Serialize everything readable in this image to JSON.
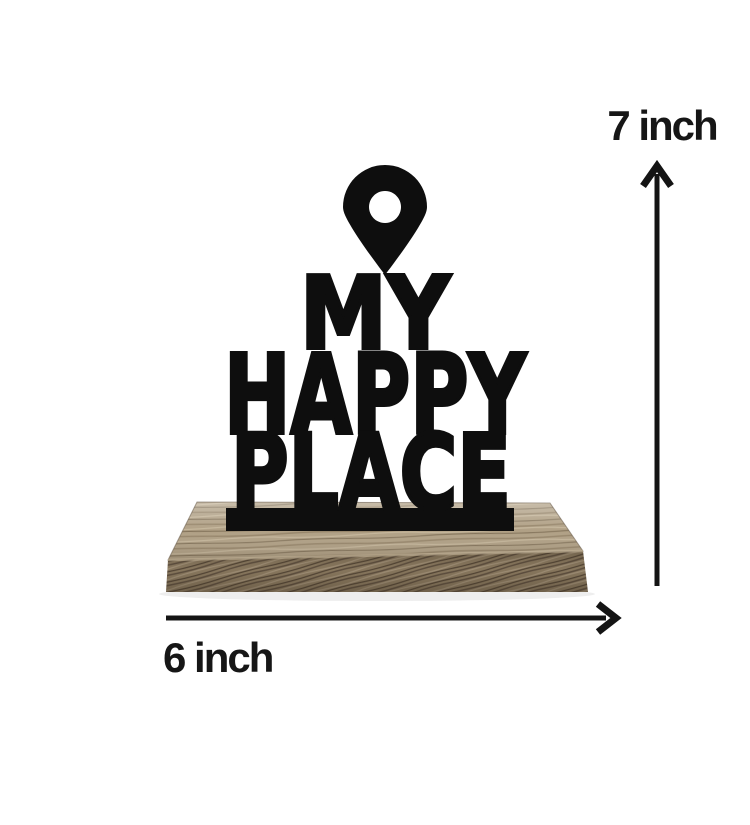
{
  "product": {
    "pin_icon": "location-pin-icon",
    "sign_lines": {
      "line1": "MY",
      "line2": "HAPPY",
      "line3": "PLACE"
    },
    "material": {
      "sign": "black cutout lettering",
      "base": "wood block"
    }
  },
  "annotations": {
    "height_label": "7 inch",
    "width_label": "6 inch"
  },
  "colors": {
    "background": "#ffffff",
    "sign": "#0e0e0e",
    "annotation": "#141414",
    "wood_top": "#b0a085",
    "wood_front": "#8c7b61",
    "wood_grain_dark": "#5f5040",
    "wood_grain_light": "#c4b59a"
  }
}
